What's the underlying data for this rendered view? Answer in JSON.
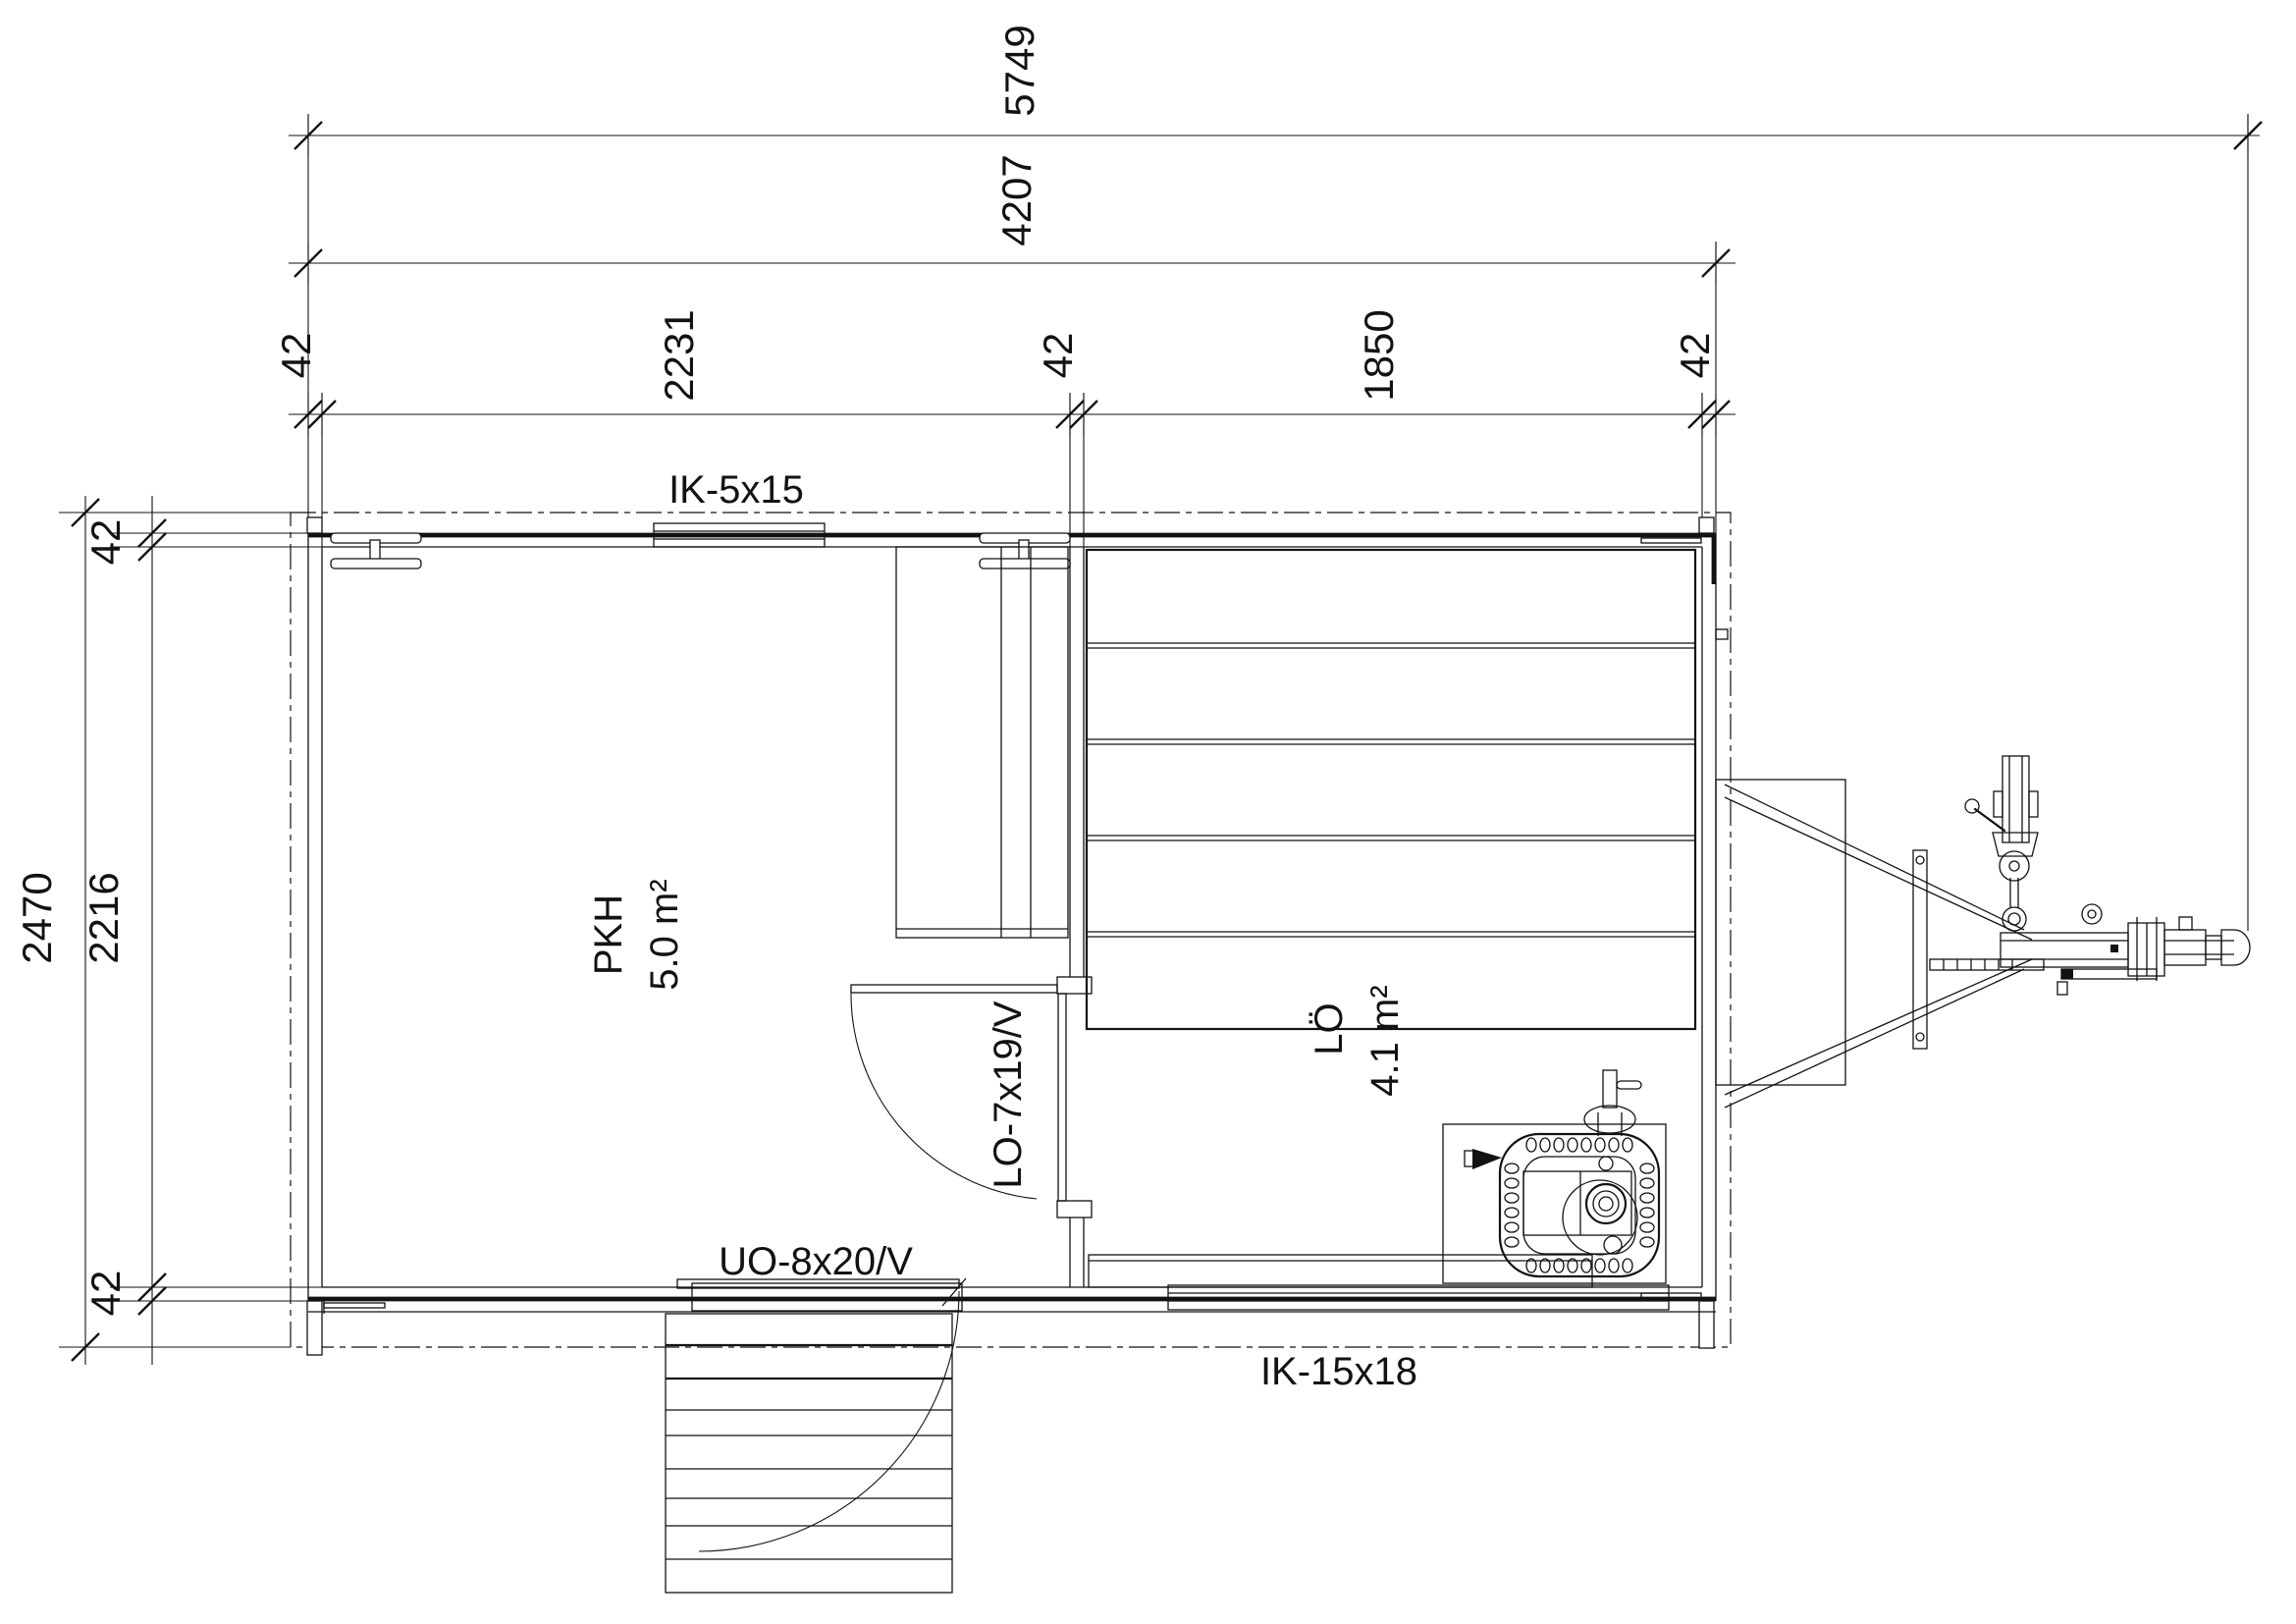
{
  "drawing": {
    "type": "floor-plan",
    "colors": {
      "line": "#121212",
      "background": "#ffffff"
    },
    "dimensions": {
      "top_row1_total": "5749",
      "top_row2_total": "4207",
      "top_row3": {
        "wall_left": "42",
        "room_left": "2231",
        "wall_mid": "42",
        "room_right": "1850",
        "wall_right": "42"
      },
      "left_col": {
        "wall_top": "42",
        "outer": "2470",
        "inner": "2216",
        "wall_bottom": "42"
      }
    },
    "rooms": [
      {
        "name": "PKH",
        "area": "5.0 m²"
      },
      {
        "name": "LÖ",
        "area": "4.1 m²"
      }
    ],
    "openings": {
      "window_top": "IK-5x15",
      "interior_door": "LO-7x19/V",
      "exterior_door": "UO-8x20/V",
      "window_bottom": "IK-15x18"
    }
  }
}
